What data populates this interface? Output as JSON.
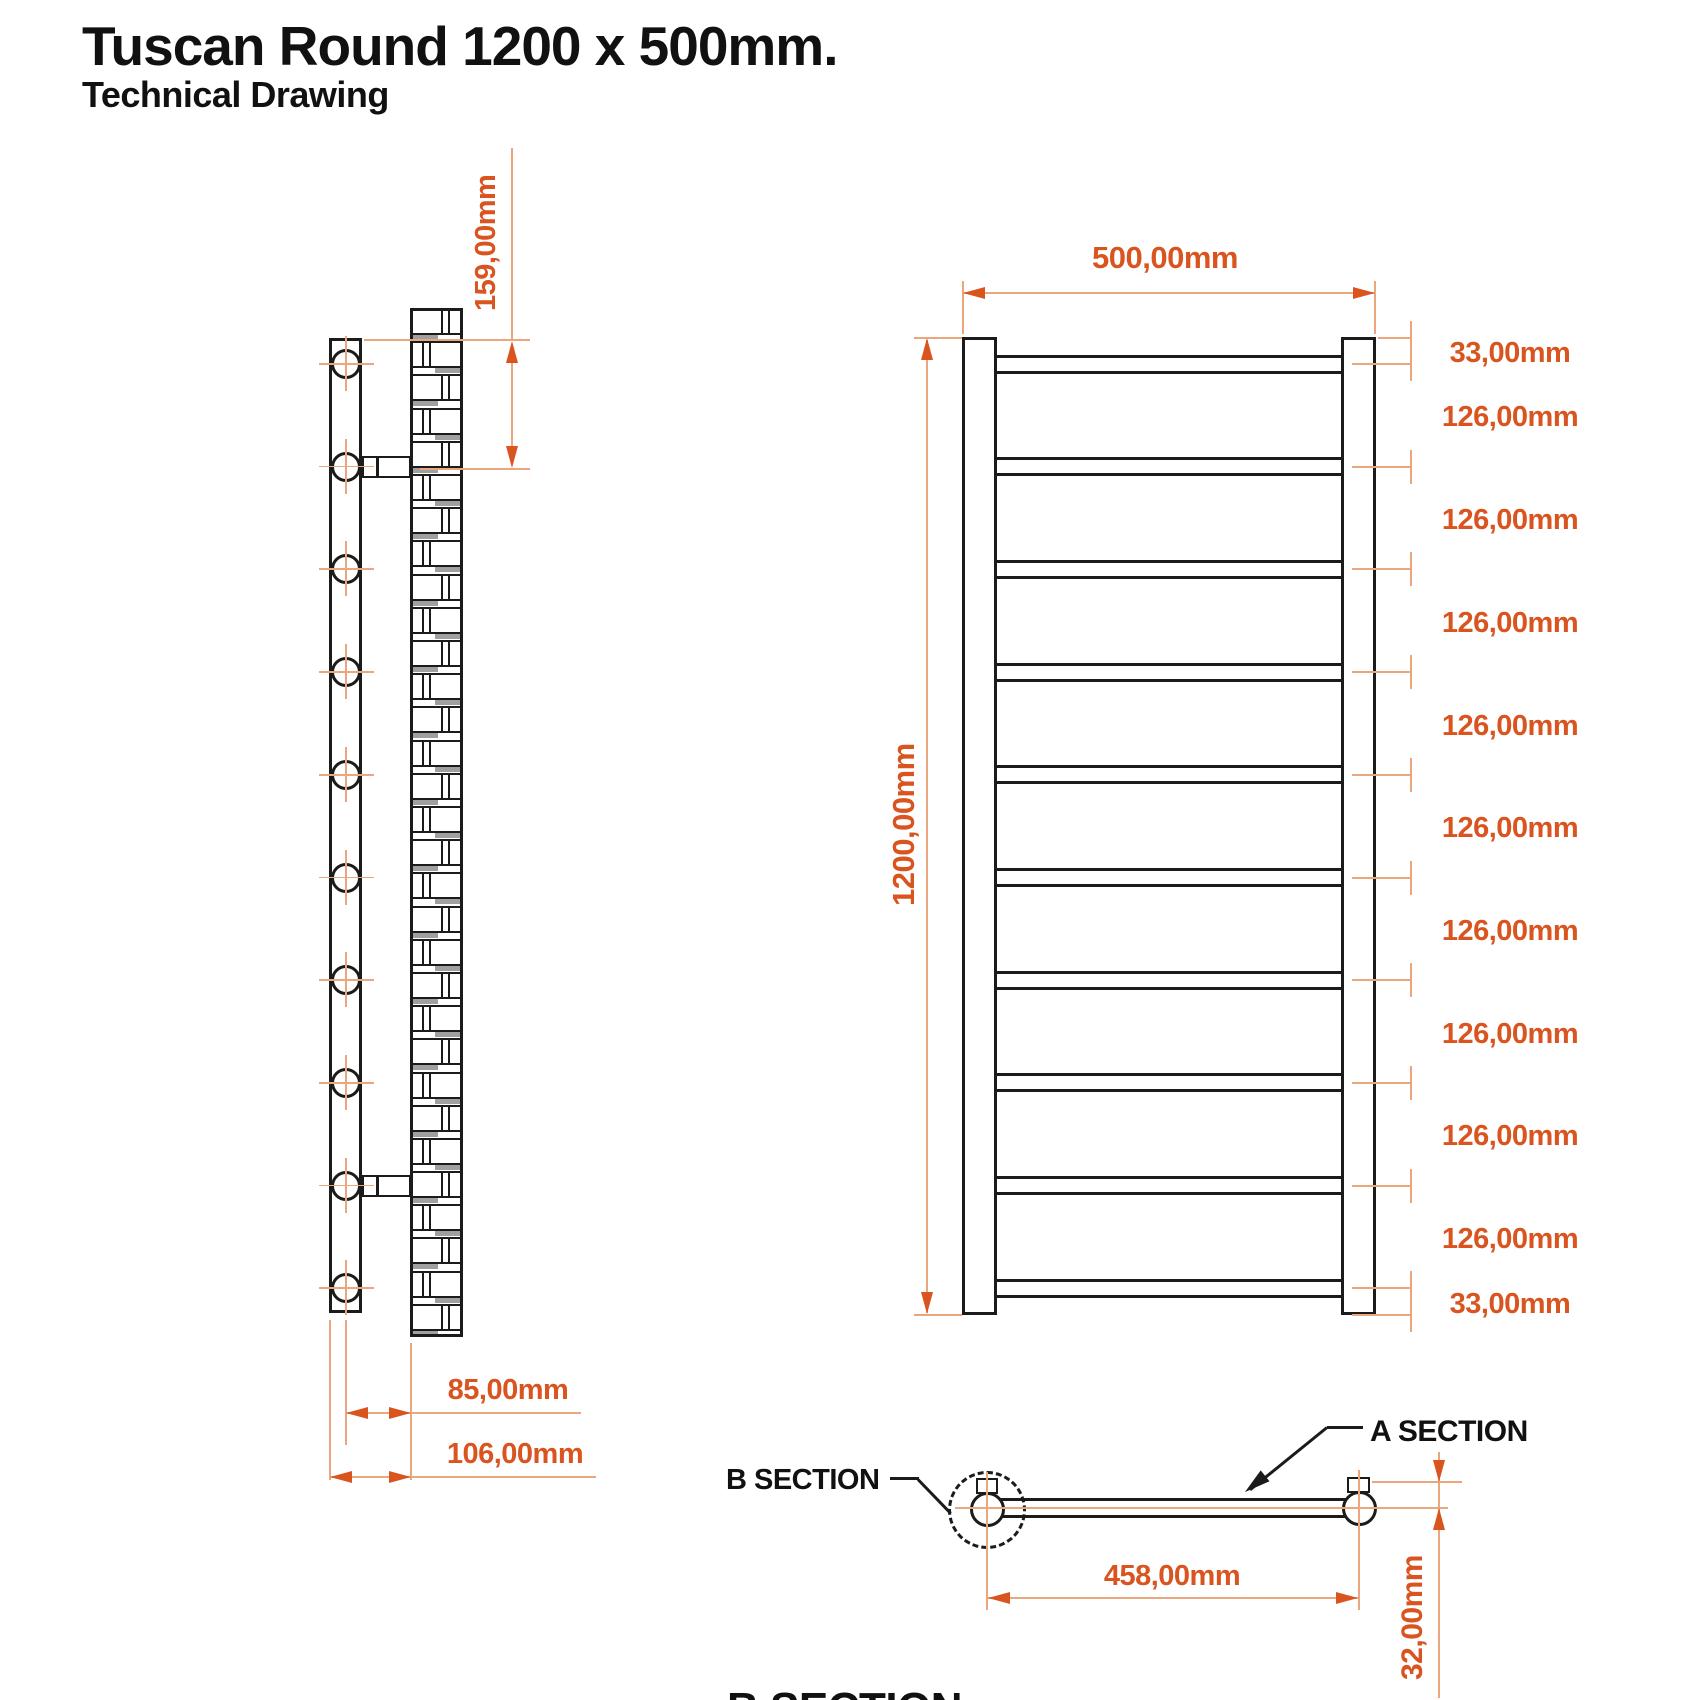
{
  "title": {
    "main": "Tuscan Round 1200 x 500mm.",
    "sub": "Technical Drawing"
  },
  "side_view": {
    "dims": {
      "bracket_offset_top": "159,00mm",
      "wall_to_tube_center": "85,00mm",
      "wall_to_tube_edge": "106,00mm"
    },
    "mounting_hole_count": 10
  },
  "front_view": {
    "dims": {
      "width": "500,00mm",
      "height": "1200,00mm"
    },
    "rung_count": 10,
    "rung_spacings": [
      "33,00mm",
      "126,00mm",
      "126,00mm",
      "126,00mm",
      "126,00mm",
      "126,00mm",
      "126,00mm",
      "126,00mm",
      "126,00mm",
      "126,00mm",
      "33,00mm"
    ]
  },
  "section_view": {
    "labels": {
      "a": "A SECTION",
      "b": "B SECTION",
      "footer": "B SECTION"
    },
    "dims": {
      "rail_centers": "458,00mm",
      "depth": "32,00mm"
    }
  },
  "colors": {
    "dim_text": "#d9541e",
    "dim_line": "#eaa77d",
    "drawing": "#1b1b1b"
  }
}
